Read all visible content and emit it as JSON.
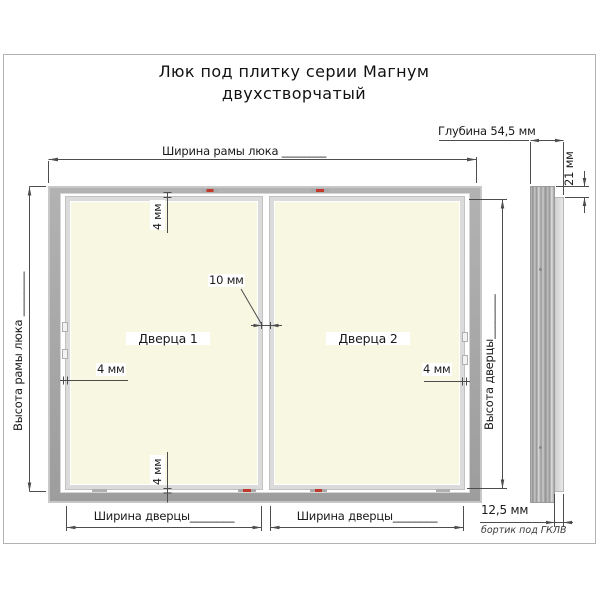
{
  "title": {
    "line1": "Люк под плитку серии Магнум",
    "line2": "двухстворчатый"
  },
  "front_view": {
    "door1_label": "Дверца 1",
    "door2_label": "Дверца 2",
    "dim_frame_width": "Ширина рамы люка ________",
    "dim_frame_height": "Высота рамы люка ________",
    "dim_door_height": "Высота дверцы________",
    "dim_door_width_left": "Ширина дверцы________",
    "dim_door_width_right": "Ширина дверцы________",
    "dim_center_gap": "10 мм",
    "dim_gap_top": "4 мм",
    "dim_gap_bottom": "4 мм",
    "dim_gap_left": "4 мм",
    "dim_gap_right": "4 мм"
  },
  "side_view": {
    "dim_depth": "Глубина 54,5 мм",
    "dim_top_offset": "21 мм",
    "dim_rim": "12,5 мм",
    "rim_note": "бортик под ГКЛВ"
  },
  "colors": {
    "door_fill": "#f7f7e2",
    "frame_gray": "#a6a6a6",
    "dimension_line": "#4d4d4d",
    "latch_red": "#c0392b"
  }
}
